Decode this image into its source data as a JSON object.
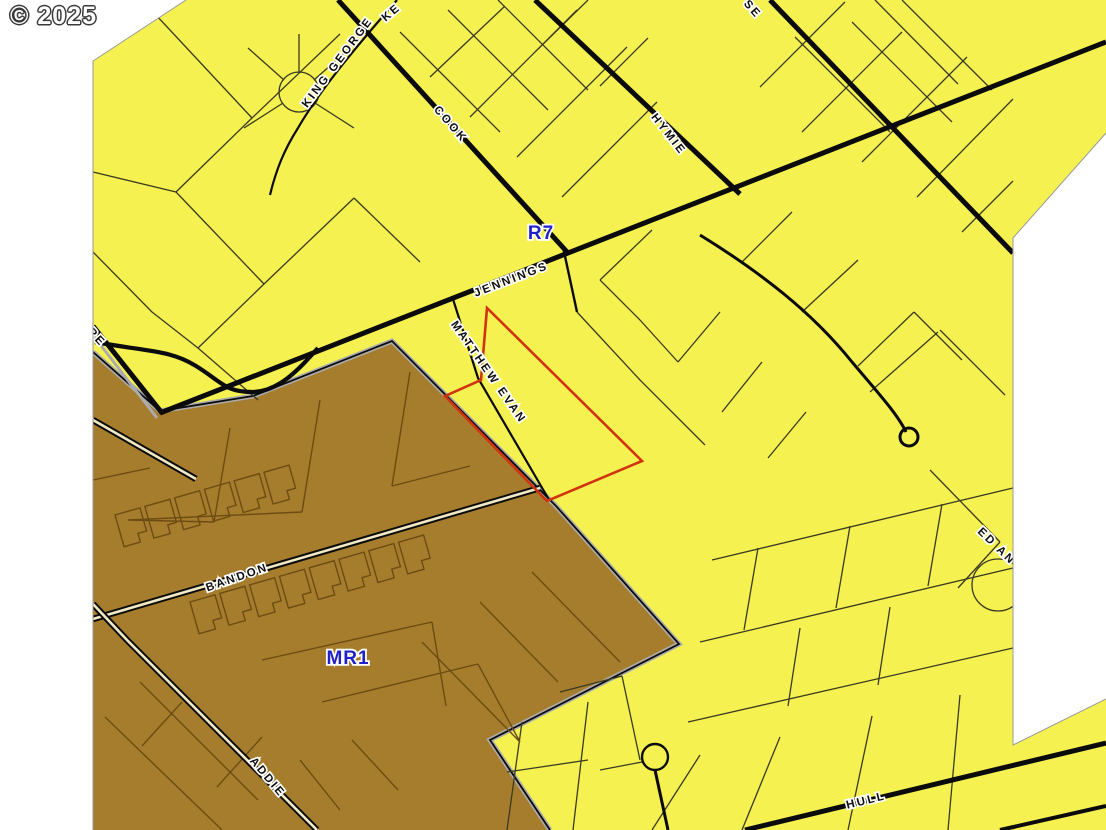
{
  "map": {
    "copyright": "© 2025",
    "zone_labels": {
      "r7": "R7",
      "mr1": "MR1"
    },
    "street_labels": {
      "ke": "KE",
      "king_george": "KING GEORGE",
      "cook": "COOK",
      "se": "SE",
      "hymie": "HYMIE",
      "jennings": "JENNINGS",
      "matthew_evan": "MATTHEW EVAN",
      "re": "RE",
      "bandon": "BANDON",
      "addie": "ADDIE",
      "hull": "HULL",
      "ed_an": "ED AN"
    },
    "colors": {
      "residential_yellow": "#F4F150",
      "multi_use_brown": "#A67D2D",
      "parcel_line_dark": "#3A3A20",
      "parcel_line_brown": "#6B4C12",
      "street_black": "#0B0B0B",
      "road_fill_cream": "#F0E9C4",
      "boundary_gray": "#ACACAC",
      "highlight_red": "#D2330F",
      "zone_label_blue": "#2121C8",
      "halo_white": "#FFFFFF",
      "background": "#FFFFFF"
    }
  }
}
